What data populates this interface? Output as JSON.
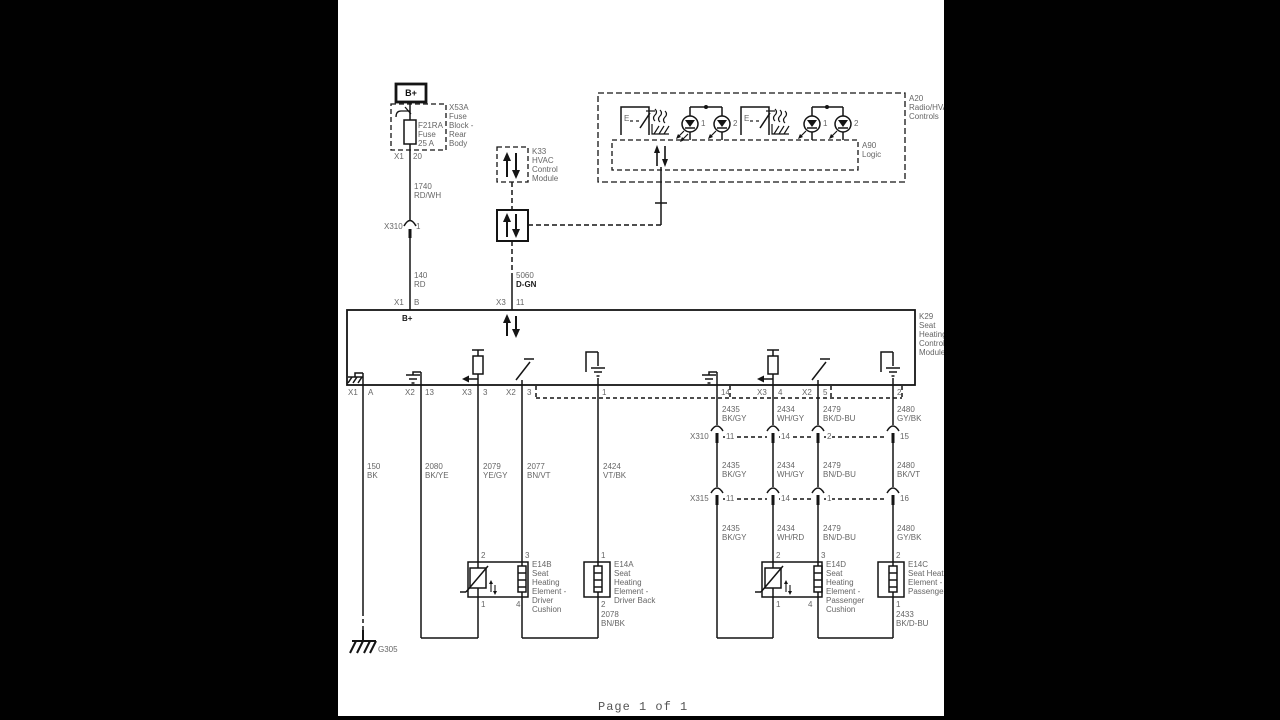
{
  "footer": "Page 1 of 1",
  "power": {
    "bplus": "B+",
    "fuse_block": "X53A\nFuse\nBlock -\nRear\nBody",
    "fuse": "F21RA\nFuse\n25 A",
    "fuse_pin_conn": "X1",
    "fuse_pin": "20",
    "wire_1740": "1740\nRD/WH",
    "x310_label": "X310",
    "x310_pin": "1",
    "wire_140": "140\nRD"
  },
  "hvac": {
    "k33": "K33\nHVAC\nControl\nModule",
    "wire_5060_ckt": "5060",
    "wire_5060_color": "D-GN",
    "a20": "A20\nRadio/HVAC\nControls",
    "a90": "A90\nLogic",
    "sw1": "E",
    "sw2": "E",
    "led_labels": [
      "1",
      "2",
      "1",
      "2"
    ]
  },
  "k29": {
    "label": "K29\nSeat\nHeating\nControl\nModule",
    "bplus": "B+",
    "top_pins": [
      {
        "conn": "X1",
        "pin": "B"
      },
      {
        "conn": "X3",
        "pin": "11"
      }
    ],
    "bottom_pins": [
      {
        "conn": "X1",
        "pin": "A"
      },
      {
        "conn": "X2",
        "pin": "13"
      },
      {
        "conn": "X3",
        "pin": "3"
      },
      {
        "conn": "X2",
        "pin": "3"
      },
      {
        "conn": "",
        "pin": "1"
      },
      {
        "conn": "",
        "pin": "14"
      },
      {
        "conn": "X3",
        "pin": "4"
      },
      {
        "conn": "X2",
        "pin": "5"
      },
      {
        "conn": "",
        "pin": "2"
      }
    ]
  },
  "wires": {
    "driver": [
      "150\nBK",
      "2080\nBK/YE",
      "2079\nYE/GY",
      "2077\nBN/VT",
      "2424\nVT/BK"
    ],
    "pass_upper": [
      "2435\nBK/GY",
      "2434\nWH/GY",
      "2479\nBK/D-BU",
      "2480\nGY/BK"
    ],
    "pass_mid": [
      "2435\nBK/GY",
      "2434\nWH/GY",
      "2479\nBN/D-BU",
      "2480\nBK/VT"
    ],
    "pass_lower": [
      "2435\nBK/GY",
      "2434\nWH/RD",
      "2479\nBN/D-BU",
      "2480\nGY/BK"
    ],
    "driver_return": "2078\nBN/BK",
    "pass_return": "2433\nBK/D-BU"
  },
  "connectors": {
    "x310": {
      "label": "X310",
      "pins": [
        "11",
        "14",
        "2",
        "15"
      ]
    },
    "x315": {
      "label": "X315",
      "pins": [
        "11",
        "14",
        "1",
        "16"
      ]
    }
  },
  "elements": {
    "e14b": {
      "label": "E14B\nSeat\nHeating\nElement -\nDriver\nCushion",
      "pins": [
        "2",
        "3",
        "1",
        "4"
      ]
    },
    "e14a": {
      "label": "E14A\nSeat\nHeating\nElement -\nDriver Back",
      "pins": [
        "1",
        "2"
      ]
    },
    "e14d": {
      "label": "E14D\nSeat\nHeating\nElement -\nPassenger\nCushion",
      "pins": [
        "2",
        "3",
        "1",
        "4"
      ]
    },
    "e14c": {
      "label": "E14C\nSeat Heating\nElement -\nPassenger Back",
      "pins": [
        "2",
        "1"
      ]
    }
  },
  "ground": {
    "g305": "G305"
  }
}
